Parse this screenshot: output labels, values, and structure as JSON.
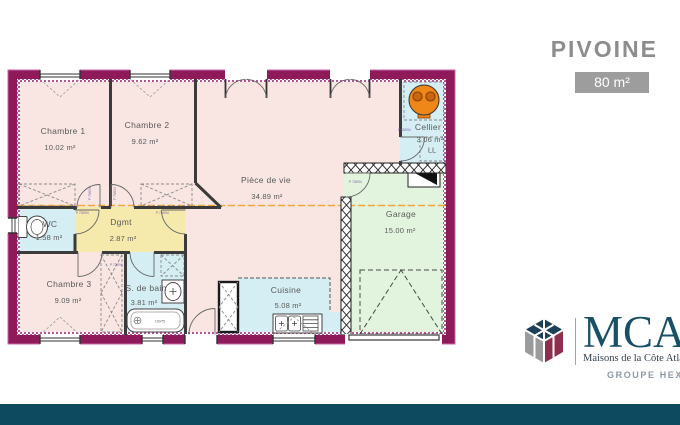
{
  "header": {
    "title": "PIVOINE",
    "area_badge": "80 m²"
  },
  "plan": {
    "rooms": [
      {
        "name": "Chambre 1",
        "area": "10.02 m²"
      },
      {
        "name": "Chambre 2",
        "area": "9.62 m²"
      },
      {
        "name": "Pièce de vie",
        "area": "34.89 m²"
      },
      {
        "name": "Cellier",
        "area": "3.06 m²"
      },
      {
        "name": "Garage",
        "area": "15.00 m²"
      },
      {
        "name": "WC",
        "area": "1.58 m²"
      },
      {
        "name": "Dgmt",
        "area": "2.87 m²"
      },
      {
        "name": "Chambre 3",
        "area": "9.09 m²"
      },
      {
        "name": "S. de bain",
        "area": "3.81 m²"
      },
      {
        "name": "Cuisine",
        "area": "5.08 m²"
      }
    ],
    "door_label": "P 73/094",
    "heater_label": "P 83/094",
    "washer_label": "LL",
    "tub_label": "190/75"
  },
  "footer_logo": {
    "brand": "MCA",
    "tagline": "Maisons de la Côte Atlantique",
    "group": "GROUPE HEXAOM"
  },
  "colors": {
    "wall": "#8f1a59",
    "bottom_bar": "#0e4a5f",
    "heater": "#ee8618",
    "section_line": "#f0a73e"
  }
}
